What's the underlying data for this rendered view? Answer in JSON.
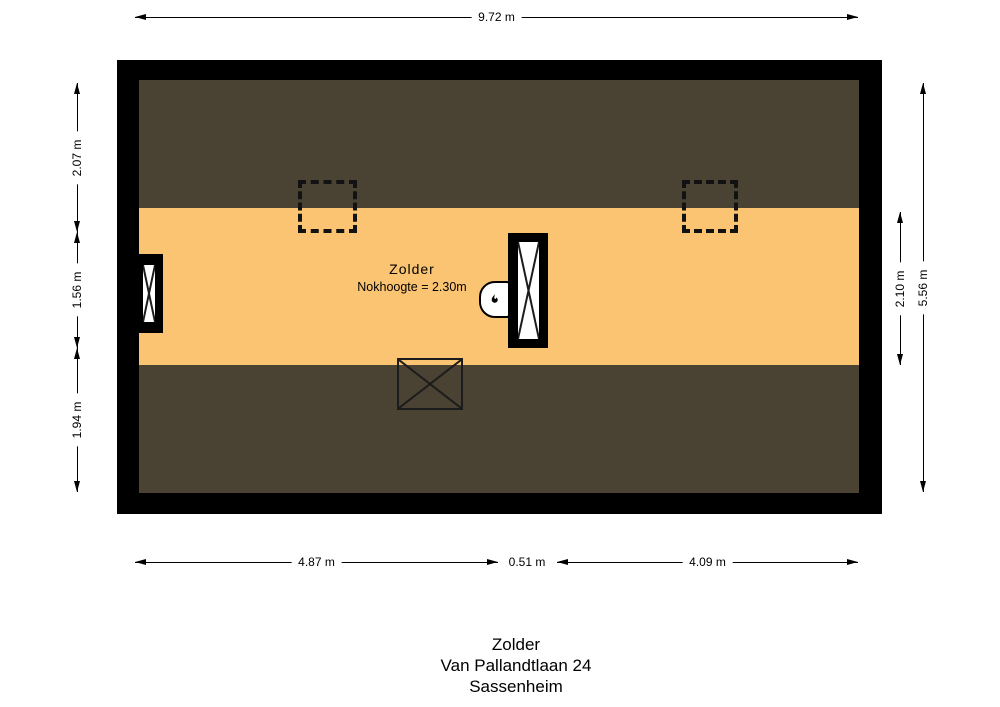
{
  "plan": {
    "room_label": "Zolder",
    "ridge_note": "Nokhoogte = 2.30m"
  },
  "dimensions": {
    "top": "9.72 m",
    "left_top": "2.07 m",
    "left_middle": "1.56 m",
    "left_bottom": "1.94 m",
    "right_inner": "2.10 m",
    "right_outer": "5.56 m",
    "bottom_left": "4.87 m",
    "bottom_middle": "0.51 m",
    "bottom_right": "4.09 m"
  },
  "caption": {
    "room": "Zolder",
    "address": "Van Pallandtlaan 24",
    "city": "Sassenheim"
  },
  "colors": {
    "wall": "#000000",
    "low_headroom_area": "#4a4233",
    "floor": "#fbc472"
  },
  "icons": {
    "boiler": "flame-icon"
  }
}
